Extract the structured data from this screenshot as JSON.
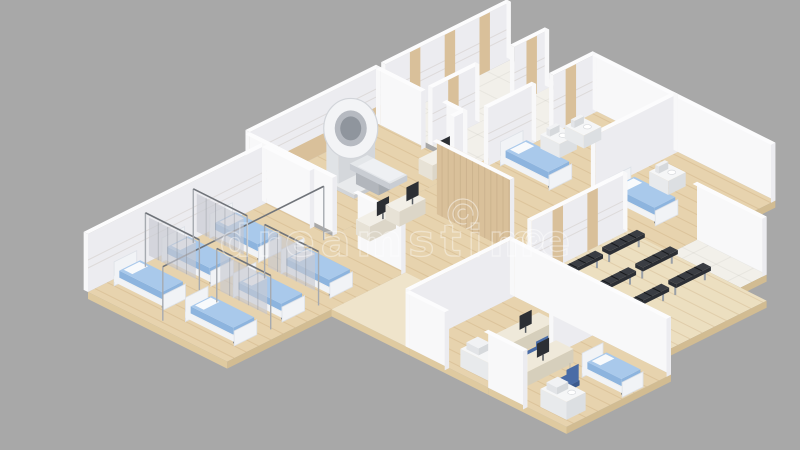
{
  "image": {
    "kind": "isometric 3D render of a hospital floor plan interior, cutaway view",
    "background": "#a8a8a8"
  },
  "watermark": {
    "text": "dreamstime",
    "color": "rgba(255,255,255,0.5)",
    "font_size": 44
  },
  "palette": {
    "background": "#a8a8a8",
    "floorWood": "#e7d3ae",
    "floorWoodLight": "#ecdfc0",
    "floorTile": "#f2f0ea",
    "plankLine": "rgba(171,128,74,0.18)",
    "tileLine": "rgba(90,80,60,0.06)",
    "slabTop": "#efe4cb",
    "slabSide": "#dfcaa0",
    "slabSideDark": "#d2bc92",
    "wallBright": "#f8f8f9",
    "wallShade": "#ececf0",
    "wallTop": "#fcfcfd",
    "wood": "#d9c09a",
    "woodDark": "#c9af83",
    "groove": "rgba(120,100,70,0.13)",
    "curtain": "rgba(199,202,209,0.65)",
    "curtainLine": "rgba(140,144,152,0.4)",
    "rail": "#70747a",
    "post": "#a6aab0",
    "bedBlue": "#a9c9eb",
    "bedBlueDark": "#8db4de",
    "bedFrame": "#f1f3f6",
    "bedFrameSide": "#dde1e7",
    "pillow": "#f8fafc",
    "legDark": "#5f646b",
    "bench": "#3a3d43",
    "benchDark": "#2c2f35",
    "benchLeg": "#9aa0a7",
    "chair": "#4a6ca6",
    "chairDark": "#3d5b8f",
    "monitor": "#2c2f34",
    "deskTop": "#f2efe7",
    "deskSideL": "#e7e2d6",
    "deskSideR": "#dcd6c8",
    "mriRing": "#f3f4f6",
    "mriRingEdge": "#d2d5da",
    "mriRingInner": "#b6bac1",
    "mriBore": "#8f959d",
    "mriTable": "#e4e7ea",
    "mriTableSide": "#c9cdd3",
    "mriBase": "#e8eaec",
    "mriBaseSide": "#d2d5d9",
    "device": "#f1f2f4"
  },
  "scene": {
    "rooms": {
      "ward": {
        "label": "open ward",
        "beds": 6,
        "curtain_dividers": 4
      },
      "mri_room": {
        "label": "imaging room",
        "mri_scanners": 1,
        "console_desks": 1
      },
      "corridor": {
        "label": "corridor"
      },
      "reception": {
        "label": "reception counters",
        "desks": 2,
        "monitors": 2
      },
      "patient_room_1": {
        "label": "patient room",
        "beds": 1,
        "side_tables": 2
      },
      "patient_room_2": {
        "label": "patient room",
        "beds": 1,
        "side_tables": 1
      },
      "waiting_area": {
        "label": "waiting area",
        "benches": 6
      },
      "office_1": {
        "label": "consultation office",
        "desks": 1,
        "monitors": 1,
        "chairs": 1,
        "cabinets": 1
      },
      "office_2": {
        "label": "consultation office",
        "desks": 1,
        "monitors": 1,
        "chairs": 1,
        "cabinets": 1,
        "exam_beds": 1
      }
    }
  }
}
